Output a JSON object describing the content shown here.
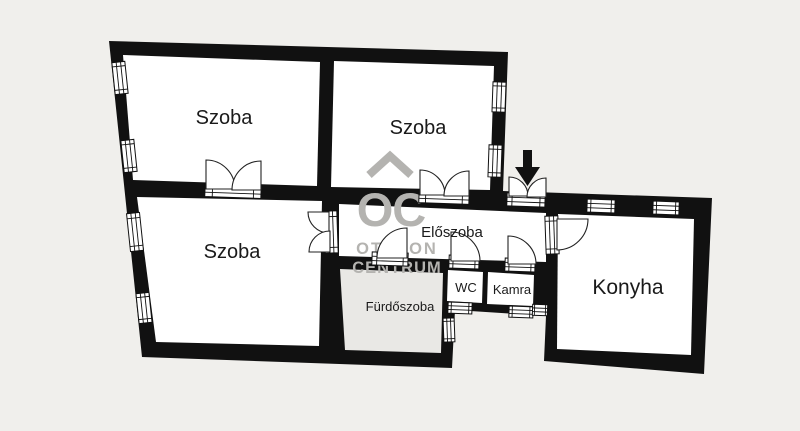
{
  "page": {
    "background_color": "#f0efec",
    "type_note": "floor plan drawing"
  },
  "floorplan": {
    "rooms": [
      {
        "id": "szoba-top-left",
        "label": "Szoba"
      },
      {
        "id": "szoba-top-center",
        "label": "Szoba"
      },
      {
        "id": "szoba-bottom-left",
        "label": "Szoba"
      },
      {
        "id": "eloszoba",
        "label": "Előszoba"
      },
      {
        "id": "furdoszoba",
        "label": "Fürdőszoba"
      },
      {
        "id": "wc",
        "label": "WC"
      },
      {
        "id": "kamra",
        "label": "Kamra"
      },
      {
        "id": "konyha",
        "label": "Konyha"
      }
    ],
    "colors": {
      "wall": "#111111",
      "room_fill": "#ffffff",
      "bathroom_fill": "#e9e8e5",
      "background": "#f0efec",
      "watermark": "#b4b3b0",
      "label_text": "#1a1a1a"
    },
    "watermark": {
      "icon": "house-roof-icon",
      "abbrev": "OC",
      "line1": "OTTHON",
      "line2": "CENTRUM"
    },
    "entrance": {
      "icon": "entrance-arrow-icon",
      "direction": "down"
    }
  }
}
